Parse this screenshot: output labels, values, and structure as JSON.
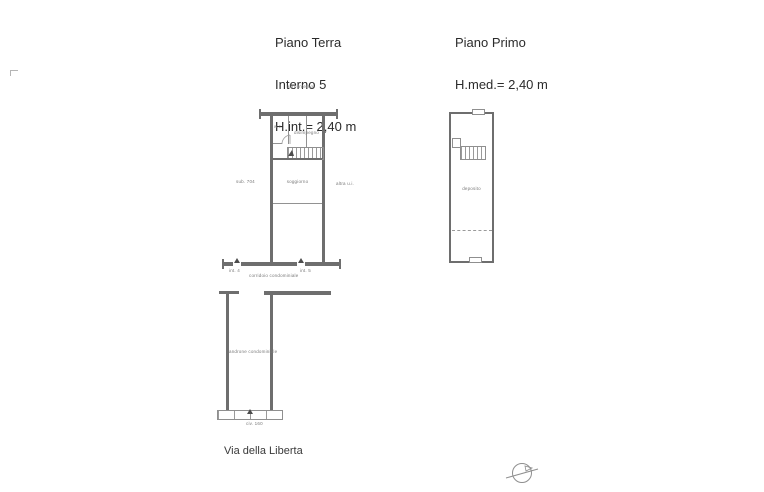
{
  "titles": {
    "ground": [
      "Piano Terra",
      "Interno 5",
      "H.int.= 2,40 m"
    ],
    "first": [
      "Piano Primo",
      "H.med.= 2,40 m"
    ]
  },
  "ground_plan": {
    "above_label": "altro interno",
    "wc": "w.c.",
    "hall": "disimpegno",
    "room": "soggiorno",
    "left_annotation": "sub. 704",
    "right_annotation": "altra u.i."
  },
  "corridor": {
    "label": "corridoio condominiale",
    "door_left": "int. 4",
    "door_right": "int. 5"
  },
  "entrance_hall": {
    "label": "androne condominiale",
    "civic": "civ. 160"
  },
  "first_plan": {
    "room": "deposito"
  },
  "footer": {
    "street": "Via della Liberta"
  },
  "colors": {
    "wall": "#6e6e6e",
    "thin_line": "#929292",
    "plan_text": "#7a7a7a",
    "title_text": "#2b2b2b"
  }
}
